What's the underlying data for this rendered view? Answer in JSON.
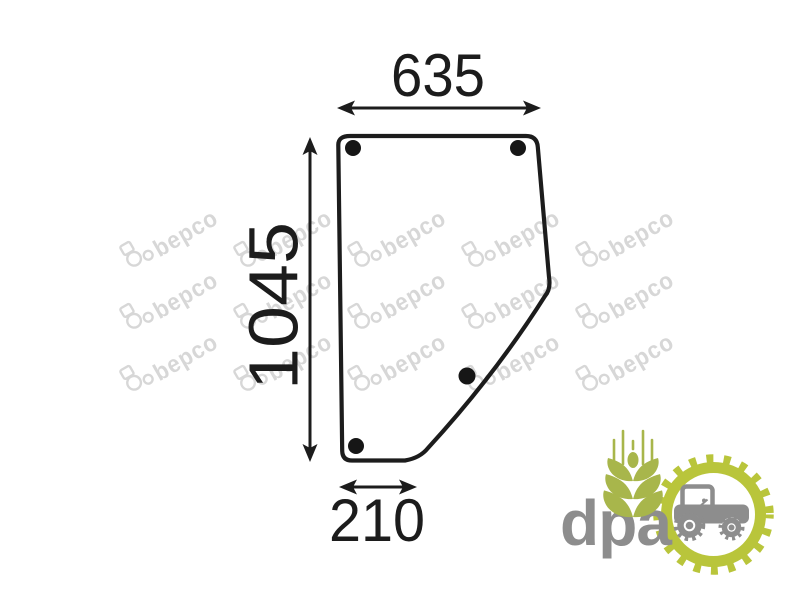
{
  "diagram": {
    "part": "door-glass-outline",
    "dimension_top": "635",
    "dimension_side": "1045",
    "dimension_bottom": "210",
    "mounting_holes": 4,
    "line_color": "#1c1c1c"
  },
  "watermark": {
    "brand": "bepco",
    "color": "#d7d7d7"
  },
  "logo": {
    "brand": "dpa",
    "text_color": "#8d8d8d",
    "ring_green": "#b9c53b",
    "wheat_green": "#a8b64b"
  }
}
